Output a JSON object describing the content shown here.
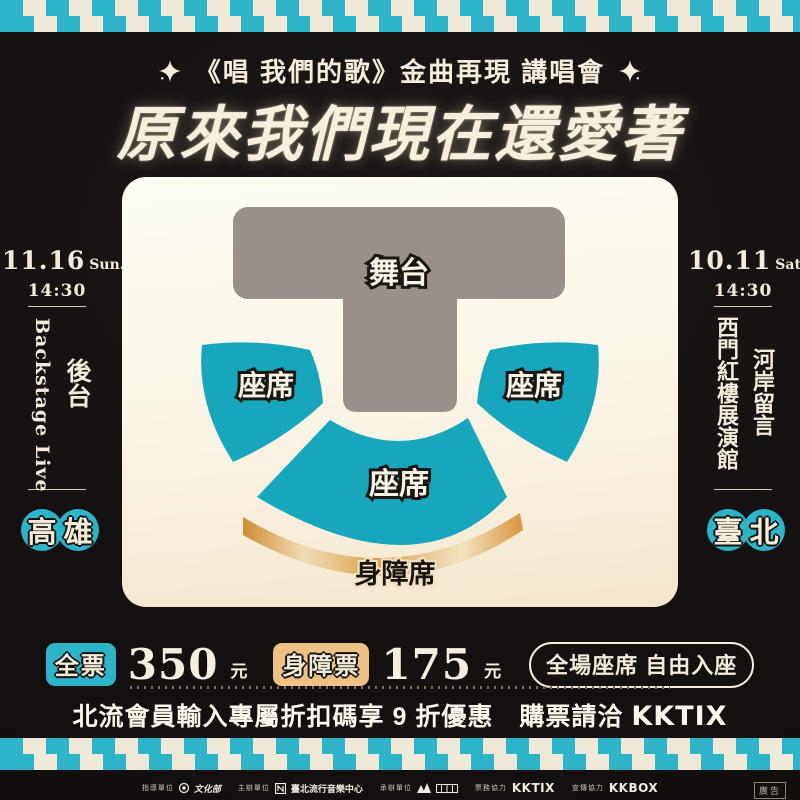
{
  "colors": {
    "teal": "#2db4c8",
    "seat-teal": "#17a6bc",
    "cream": "#f2ecd9",
    "stage-gray": "#99908a",
    "bg": "#171212"
  },
  "header": {
    "subtitle": "《唱 我們的歌》金曲再現 講唱會",
    "title": "原來我們現在還愛著"
  },
  "left_panel": {
    "date": "11.16",
    "weekday": "Sun.",
    "time": "14:30",
    "venue_en": "Backstage Live",
    "venue_zh": "後台",
    "city_char_1": "高",
    "city_char_2": "雄"
  },
  "right_panel": {
    "date": "10.11",
    "weekday": "Sat.",
    "time": "14:30",
    "venue_col_1": "河岸留言",
    "venue_col_2": "西門紅樓展演館",
    "city_char_1": "臺",
    "city_char_2": "北"
  },
  "seatmap": {
    "stage_label": "舞台",
    "seat_left_label": "座席",
    "seat_right_label": "座席",
    "seat_center_label": "座席",
    "accessible_label": "身障席"
  },
  "pricing": {
    "full_ticket_label": "全票",
    "full_ticket_price": "350",
    "currency_unit": "元",
    "accessible_ticket_label": "身障票",
    "accessible_ticket_price": "175",
    "seating_note": "全場座席 自由入座"
  },
  "promo": {
    "discount_text": "北流會員輸入專屬折扣碼享 9 折優惠",
    "purchase_text": "購票請洽",
    "ticket_vendor": "KKTIX"
  },
  "footer": {
    "credit_1_label": "指導單位",
    "credit_1_name": "文化部",
    "credit_2_label": "主辦單位",
    "credit_2_name": "臺北流行音樂中心",
    "credit_3_label": "承辦單位",
    "credit_4_label": "票務協力",
    "credit_4_name": "KKTIX",
    "credit_5_label": "宣傳協力",
    "credit_5_name": "KKBOX",
    "ad_label": "廣告"
  }
}
